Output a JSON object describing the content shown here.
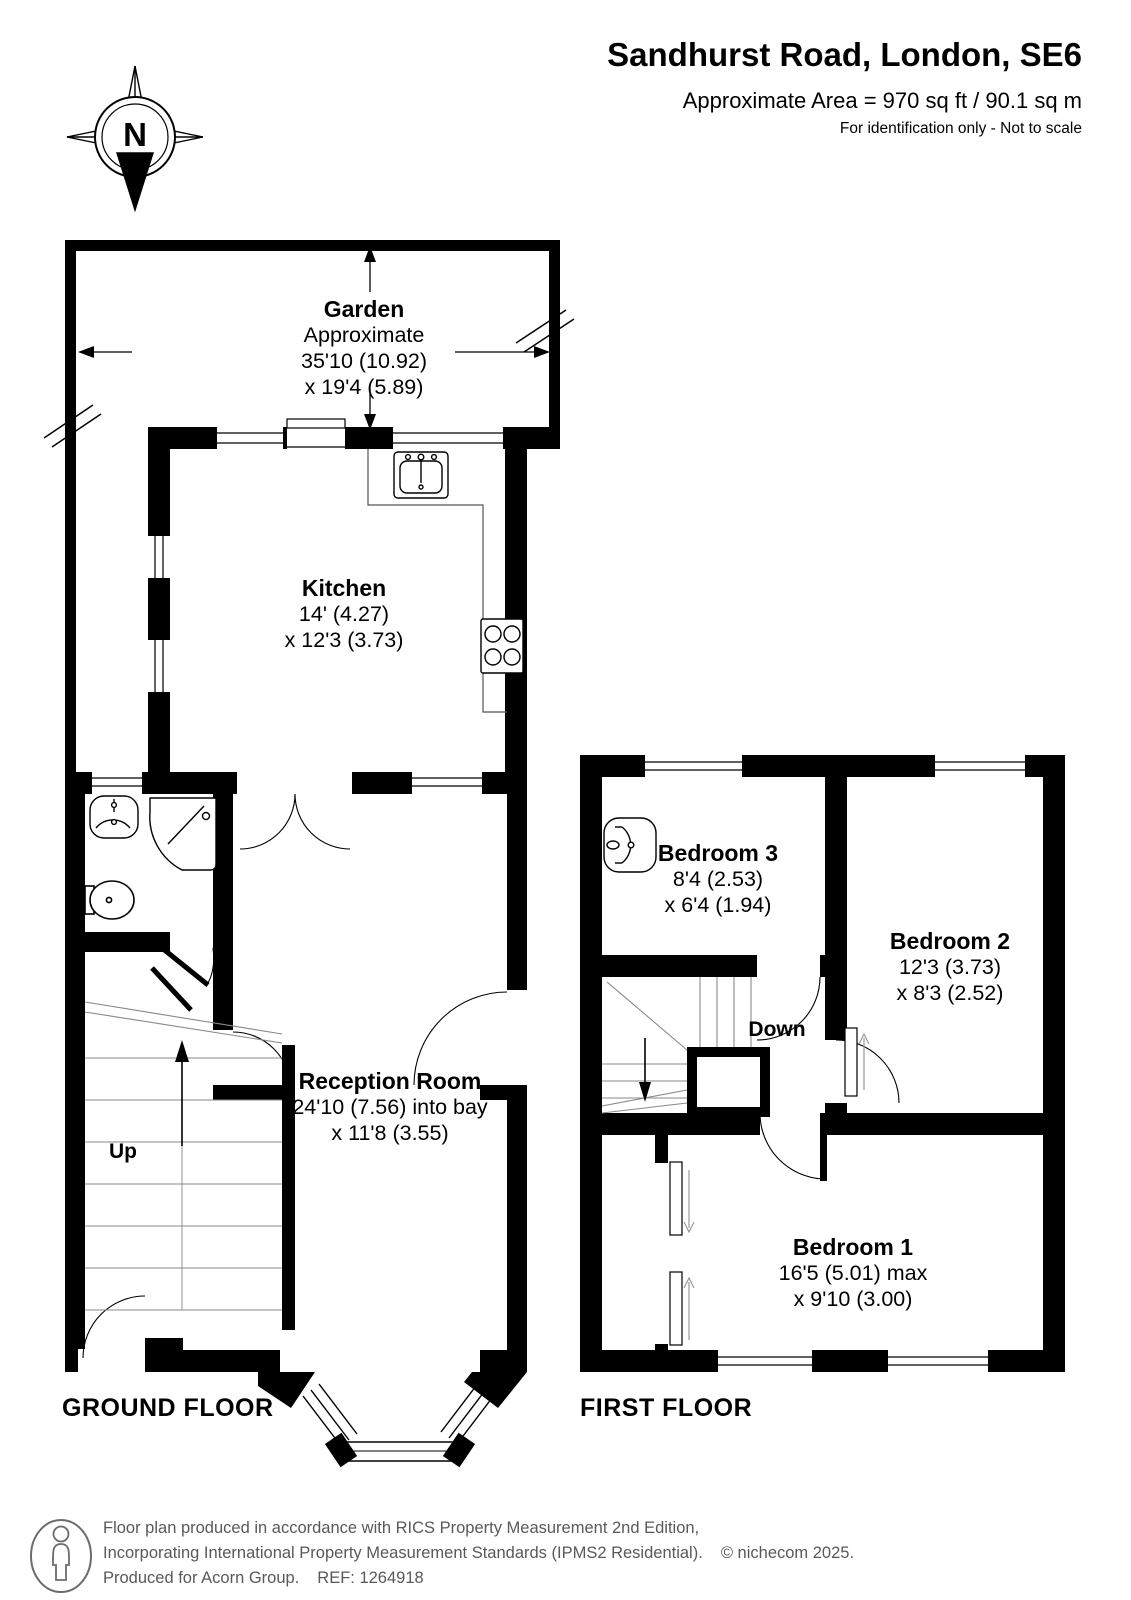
{
  "header": {
    "title": "Sandhurst Road, London, SE6",
    "area": "Approximate Area = 970 sq ft / 90.1 sq m",
    "note": "For identification only - Not to scale"
  },
  "compass": {
    "letter": "N"
  },
  "ground_floor": {
    "floor_label": "GROUND FLOOR",
    "stairs_label": "Up",
    "rooms": {
      "garden": {
        "name": "Garden",
        "line1": "Approximate",
        "line2": "35'10 (10.92)",
        "line3": "x 19'4 (5.89)"
      },
      "kitchen": {
        "name": "Kitchen",
        "line1": "14' (4.27)",
        "line2": "x 12'3 (3.73)"
      },
      "reception": {
        "name": "Reception Room",
        "line1": "24'10 (7.56) into bay",
        "line2": "x 11'8 (3.55)"
      }
    }
  },
  "first_floor": {
    "floor_label": "FIRST FLOOR",
    "stairs_label": "Down",
    "rooms": {
      "bedroom3": {
        "name": "Bedroom 3",
        "line1": "8'4 (2.53)",
        "line2": "x 6'4 (1.94)"
      },
      "bedroom2": {
        "name": "Bedroom 2",
        "line1": "12'3 (3.73)",
        "line2": "x 8'3 (2.52)"
      },
      "bedroom1": {
        "name": "Bedroom 1",
        "line1": "16'5 (5.01) max",
        "line2": "x 9'10 (3.00)"
      }
    }
  },
  "footer": {
    "line1": "Floor plan produced in accordance with RICS Property Measurement 2nd Edition,",
    "line2a": "Incorporating International Property Measurement Standards (IPMS2 Residential).",
    "line2b": "© nichecom 2025.",
    "line3a": "Produced for Acorn Group.",
    "line3b": "REF: 1264918"
  }
}
